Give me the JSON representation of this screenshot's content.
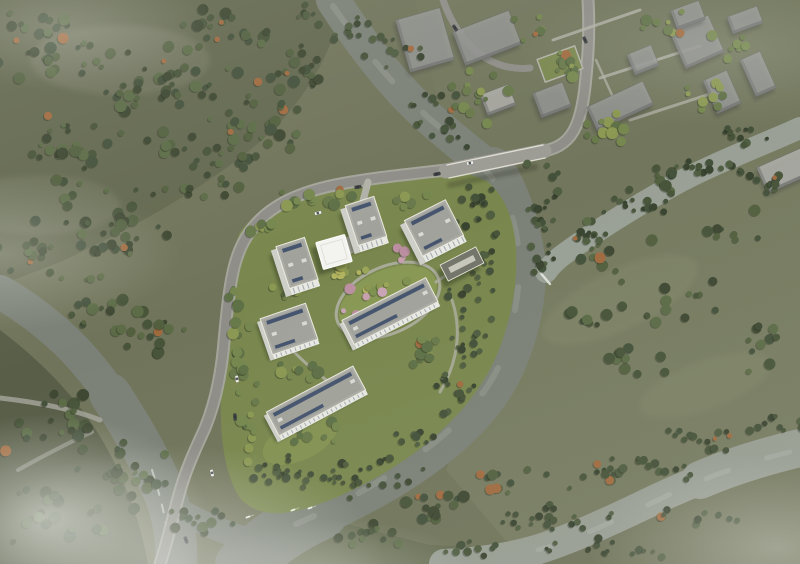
{
  "meta": {
    "title": "Aerial masterplan rendering of riverside residential development",
    "media_type": "architectural-visualization",
    "view": "bird's-eye aerial",
    "atmosphere": "overcast daylight with low mist in corners",
    "visible_text": "none"
  },
  "colors": {
    "base": "#70745a",
    "woodland": "#63684f",
    "woodland_dark": "#585e48",
    "woodland_haze": "#8a8c78",
    "field": "#767b60",
    "field_light": "#858a6c",
    "wedge": "#656c51",
    "context_ground": "#71765c",
    "river": "#7b8177",
    "river_light": "#979d92",
    "channel": "#99a095",
    "water_streak": "rgba(255,255,255,0.12)",
    "whitewater": "#e9ece5",
    "road": "#8e8d87",
    "road_edge": "#a7a69e",
    "path": "#b2b1a7",
    "bridge": "#9c9b94",
    "bridge_shadow": "rgba(40,44,38,0.30)",
    "lawn": "#79874e",
    "lawn_bright": "#8a9a55",
    "roof": "#abaca5",
    "roof_inner": "#9fa099",
    "roof_edge": "#eceade",
    "facade": "#e9e9e4",
    "facade_shade": "#cfcfca",
    "window": "#9aa4ab",
    "solar": "#40506b",
    "rooftop_unit": "#d9d9d4",
    "building_shadow": "rgba(38,42,32,0.42)",
    "canopy": "#f3f3ef",
    "amenity_roof": "#73756b",
    "skylight": "#c7c8bb",
    "context_fill": "rgba(151,152,150,0.82)",
    "context_light": "rgba(176,176,172,0.85)",
    "context_side": "rgba(113,114,112,0.80)",
    "context_shadow": "rgba(45,48,42,0.30)",
    "car_white": "#ecedea",
    "car_dark": "#3f4044",
    "car_glass": "rgba(40,45,50,0.8)",
    "boat": "#eef0ea",
    "tree": {
      "d": [
        "#3d4731",
        "#475439",
        "#52603f",
        "#43513b",
        "#5b6b46"
      ],
      "l": [
        "#68794a",
        "#75874e",
        "#8a9852",
        "#5e7046"
      ],
      "y": [
        "#9aa557",
        "#b1b35f",
        "#7f9150",
        "#8a9852"
      ],
      "p": [
        "#c79fae",
        "#bb8fa0",
        "#c9a3b4"
      ],
      "r": [
        "#394430",
        "#44513a",
        "#4f5d40",
        "#475439"
      ],
      "accent": "#a06a3f",
      "shadow": "rgba(28,33,23,0.32)"
    }
  },
  "site": {
    "name": "riverside-residential-complex",
    "buildings": [
      {
        "id": "tower-a",
        "label": "residential tower north",
        "type": "tower",
        "x": 366,
        "y": 221,
        "w": 30,
        "h": 42,
        "rot": -18
      },
      {
        "id": "tower-b",
        "label": "residential tower northeast",
        "type": "tower",
        "x": 434,
        "y": 228,
        "w": 46,
        "h": 40,
        "rot": -27
      },
      {
        "id": "tower-c",
        "label": "residential tower west",
        "type": "tower",
        "x": 297,
        "y": 263,
        "w": 30,
        "h": 44,
        "rot": -18
      },
      {
        "id": "entry-canopy",
        "label": "white entrance canopy pavilion",
        "type": "canopy",
        "x": 334,
        "y": 252,
        "w": 30,
        "h": 28,
        "rot": -16
      },
      {
        "id": "clubhouse",
        "label": "low amenity building with skylight",
        "type": "amenity",
        "x": 462,
        "y": 264,
        "w": 40,
        "h": 18,
        "rot": -27
      },
      {
        "id": "slab-a",
        "label": "central residential slab",
        "type": "slab",
        "x": 390,
        "y": 311,
        "w": 94,
        "h": 27,
        "rot": -27
      },
      {
        "id": "slab-b",
        "label": "west residential slab",
        "type": "slab",
        "x": 289,
        "y": 329,
        "w": 48,
        "h": 38,
        "rot": -19
      },
      {
        "id": "slab-c",
        "label": "south residential slab",
        "type": "slab",
        "x": 316,
        "y": 401,
        "w": 98,
        "h": 27,
        "rot": -28
      }
    ]
  },
  "context": {
    "label": "surrounding development massing (translucent grey blocks)",
    "blocks": [
      {
        "x": 425,
        "y": 40,
        "w": 46,
        "h": 54,
        "rot": -16,
        "light": false
      },
      {
        "x": 487,
        "y": 38,
        "w": 60,
        "h": 36,
        "rot": -21,
        "light": false
      },
      {
        "x": 498,
        "y": 100,
        "w": 30,
        "h": 22,
        "rot": -21,
        "light": true
      },
      {
        "x": 552,
        "y": 100,
        "w": 32,
        "h": 26,
        "rot": -21,
        "light": false
      },
      {
        "x": 620,
        "y": 106,
        "w": 62,
        "h": 26,
        "rot": -25,
        "light": false
      },
      {
        "x": 643,
        "y": 60,
        "w": 26,
        "h": 22,
        "rot": -22,
        "light": false
      },
      {
        "x": 697,
        "y": 42,
        "w": 42,
        "h": 40,
        "rot": -24,
        "light": false
      },
      {
        "x": 722,
        "y": 92,
        "w": 26,
        "h": 36,
        "rot": -24,
        "light": false
      },
      {
        "x": 758,
        "y": 74,
        "w": 22,
        "h": 40,
        "rot": -24,
        "light": false
      },
      {
        "x": 688,
        "y": 15,
        "w": 30,
        "h": 20,
        "rot": -20,
        "light": false
      },
      {
        "x": 745,
        "y": 20,
        "w": 32,
        "h": 18,
        "rot": -20,
        "light": false
      },
      {
        "x": 786,
        "y": 170,
        "w": 52,
        "h": 28,
        "rot": -24,
        "light": true
      }
    ]
  },
  "vegetation": {
    "zones": [
      {
        "x": 55,
        "y": 45,
        "rx": 75,
        "ry": 38,
        "n": 34,
        "p": "d"
      },
      {
        "x": 165,
        "y": 85,
        "rx": 85,
        "ry": 45,
        "n": 40,
        "p": "d"
      },
      {
        "x": 70,
        "y": 150,
        "rx": 70,
        "ry": 42,
        "n": 30,
        "p": "d"
      },
      {
        "x": 195,
        "y": 165,
        "rx": 75,
        "ry": 40,
        "n": 32,
        "p": "d"
      },
      {
        "x": 115,
        "y": 225,
        "rx": 85,
        "ry": 38,
        "n": 34,
        "p": "d"
      },
      {
        "x": 262,
        "y": 115,
        "rx": 55,
        "ry": 55,
        "n": 30,
        "p": "d"
      },
      {
        "x": 235,
        "y": 30,
        "rx": 55,
        "ry": 28,
        "n": 20,
        "p": "d"
      },
      {
        "x": 305,
        "y": 75,
        "rx": 38,
        "ry": 36,
        "n": 18,
        "p": "d"
      },
      {
        "x": 25,
        "y": 255,
        "rx": 40,
        "ry": 22,
        "n": 12,
        "p": "d"
      },
      {
        "x": 100,
        "y": 300,
        "rx": 50,
        "ry": 28,
        "n": 16,
        "p": "d"
      },
      {
        "x": 152,
        "y": 332,
        "rx": 55,
        "ry": 30,
        "n": 18,
        "p": "d"
      },
      {
        "x": 58,
        "y": 418,
        "rx": 55,
        "ry": 35,
        "n": 20,
        "p": "d"
      },
      {
        "x": 128,
        "y": 478,
        "rx": 65,
        "ry": 40,
        "n": 24,
        "p": "d"
      },
      {
        "x": 58,
        "y": 515,
        "rx": 70,
        "ry": 35,
        "n": 22,
        "p": "d"
      },
      {
        "x": 200,
        "y": 520,
        "rx": 40,
        "ry": 24,
        "n": 12,
        "p": "d"
      },
      {
        "x": 350,
        "y": 200,
        "rx": 95,
        "ry": 12,
        "n": 18,
        "p": "l"
      },
      {
        "x": 262,
        "y": 228,
        "rx": 24,
        "ry": 14,
        "n": 8,
        "p": "l"
      },
      {
        "x": 240,
        "y": 330,
        "rx": 13,
        "ry": 65,
        "n": 18,
        "p": "l"
      },
      {
        "x": 252,
        "y": 425,
        "rx": 15,
        "ry": 48,
        "n": 13,
        "p": "l"
      },
      {
        "x": 388,
        "y": 55,
        "rx": 40,
        "ry": 28,
        "n": 12,
        "p": "r"
      },
      {
        "x": 432,
        "y": 105,
        "rx": 26,
        "ry": 26,
        "n": 10,
        "p": "r"
      },
      {
        "x": 545,
        "y": 205,
        "rx": 20,
        "ry": 55,
        "n": 20,
        "p": "r"
      },
      {
        "x": 540,
        "y": 258,
        "rx": 16,
        "ry": 22,
        "n": 8,
        "p": "r"
      },
      {
        "x": 352,
        "y": 28,
        "rx": 30,
        "ry": 22,
        "n": 9,
        "p": "r"
      },
      {
        "x": 312,
        "y": 12,
        "rx": 24,
        "ry": 14,
        "n": 6,
        "p": "r"
      },
      {
        "x": 478,
        "y": 205,
        "rx": 26,
        "ry": 30,
        "n": 14,
        "p": "r"
      },
      {
        "x": 486,
        "y": 262,
        "rx": 20,
        "ry": 40,
        "n": 16,
        "p": "r"
      },
      {
        "x": 472,
        "y": 330,
        "rx": 22,
        "ry": 40,
        "n": 16,
        "p": "r"
      },
      {
        "x": 448,
        "y": 395,
        "rx": 30,
        "ry": 28,
        "n": 14,
        "p": "r"
      },
      {
        "x": 455,
        "y": 290,
        "rx": 16,
        "ry": 12,
        "n": 6,
        "p": "r"
      },
      {
        "x": 390,
        "y": 296,
        "rx": 46,
        "ry": 20,
        "n": 13,
        "p": "y"
      },
      {
        "x": 348,
        "y": 272,
        "rx": 24,
        "ry": 16,
        "n": 8,
        "p": "y"
      },
      {
        "x": 360,
        "y": 305,
        "rx": 35,
        "ry": 18,
        "n": 6,
        "p": "p"
      },
      {
        "x": 415,
        "y": 250,
        "rx": 28,
        "ry": 12,
        "n": 7,
        "p": "p"
      },
      {
        "x": 428,
        "y": 352,
        "rx": 32,
        "ry": 16,
        "n": 9,
        "p": "l"
      },
      {
        "x": 300,
        "y": 372,
        "rx": 28,
        "ry": 14,
        "n": 8,
        "p": "l"
      },
      {
        "x": 318,
        "y": 432,
        "rx": 30,
        "ry": 14,
        "n": 8,
        "p": "l"
      },
      {
        "x": 282,
        "y": 290,
        "rx": 20,
        "ry": 12,
        "n": 6,
        "p": "l"
      },
      {
        "x": 352,
        "y": 478,
        "rx": 85,
        "ry": 25,
        "n": 28,
        "p": "r"
      },
      {
        "x": 270,
        "y": 468,
        "rx": 40,
        "ry": 22,
        "n": 13,
        "p": "r"
      },
      {
        "x": 418,
        "y": 440,
        "rx": 35,
        "ry": 20,
        "n": 11,
        "p": "r"
      },
      {
        "x": 598,
        "y": 245,
        "rx": 55,
        "ry": 30,
        "n": 12,
        "p": "d"
      },
      {
        "x": 678,
        "y": 300,
        "rx": 65,
        "ry": 35,
        "n": 14,
        "p": "d"
      },
      {
        "x": 622,
        "y": 362,
        "rx": 50,
        "ry": 28,
        "n": 11,
        "p": "d"
      },
      {
        "x": 728,
        "y": 225,
        "rx": 38,
        "ry": 22,
        "n": 8,
        "p": "d"
      },
      {
        "x": 755,
        "y": 350,
        "rx": 40,
        "ry": 28,
        "n": 10,
        "p": "d"
      },
      {
        "x": 665,
        "y": 182,
        "rx": 45,
        "ry": 18,
        "n": 9,
        "p": "d"
      },
      {
        "x": 580,
        "y": 320,
        "rx": 30,
        "ry": 20,
        "n": 7,
        "p": "d"
      },
      {
        "x": 700,
        "y": 170,
        "rx": 55,
        "ry": 15,
        "n": 18,
        "p": "r"
      },
      {
        "x": 640,
        "y": 205,
        "rx": 45,
        "ry": 13,
        "n": 14,
        "p": "r"
      },
      {
        "x": 588,
        "y": 238,
        "rx": 40,
        "ry": 12,
        "n": 12,
        "p": "r"
      },
      {
        "x": 745,
        "y": 135,
        "rx": 35,
        "ry": 12,
        "n": 11,
        "p": "r"
      },
      {
        "x": 772,
        "y": 185,
        "rx": 28,
        "ry": 15,
        "n": 10,
        "p": "r"
      },
      {
        "x": 628,
        "y": 472,
        "rx": 85,
        "ry": 18,
        "n": 26,
        "p": "r"
      },
      {
        "x": 548,
        "y": 520,
        "rx": 70,
        "ry": 16,
        "n": 21,
        "p": "r"
      },
      {
        "x": 712,
        "y": 438,
        "rx": 55,
        "ry": 15,
        "n": 16,
        "p": "r"
      },
      {
        "x": 775,
        "y": 425,
        "rx": 30,
        "ry": 12,
        "n": 8,
        "p": "r"
      },
      {
        "x": 600,
        "y": 548,
        "rx": 80,
        "ry": 12,
        "n": 16,
        "p": "r"
      },
      {
        "x": 700,
        "y": 515,
        "rx": 60,
        "ry": 13,
        "n": 12,
        "p": "r"
      },
      {
        "x": 470,
        "y": 548,
        "rx": 40,
        "ry": 11,
        "n": 9,
        "p": "r"
      },
      {
        "x": 432,
        "y": 502,
        "rx": 55,
        "ry": 24,
        "n": 18,
        "p": "d"
      },
      {
        "x": 368,
        "y": 535,
        "rx": 45,
        "ry": 16,
        "n": 12,
        "p": "d"
      },
      {
        "x": 500,
        "y": 482,
        "rx": 35,
        "ry": 18,
        "n": 10,
        "p": "d"
      },
      {
        "x": 478,
        "y": 92,
        "rx": 35,
        "ry": 35,
        "n": 14,
        "p": "l"
      },
      {
        "x": 558,
        "y": 62,
        "rx": 30,
        "ry": 24,
        "n": 11,
        "p": "l"
      },
      {
        "x": 608,
        "y": 130,
        "rx": 35,
        "ry": 20,
        "n": 11,
        "p": "l"
      },
      {
        "x": 700,
        "y": 92,
        "rx": 32,
        "ry": 22,
        "n": 9,
        "p": "l"
      },
      {
        "x": 662,
        "y": 22,
        "rx": 35,
        "ry": 16,
        "n": 9,
        "p": "l"
      },
      {
        "x": 732,
        "y": 48,
        "rx": 24,
        "ry": 16,
        "n": 7,
        "p": "l"
      },
      {
        "x": 452,
        "y": 132,
        "rx": 26,
        "ry": 20,
        "n": 9,
        "p": "r"
      },
      {
        "x": 530,
        "y": 28,
        "rx": 24,
        "ry": 16,
        "n": 7,
        "p": "l"
      }
    ]
  },
  "vehicles": {
    "cars": [
      {
        "x": 318,
        "y": 213,
        "rot": -14,
        "c": "white"
      },
      {
        "x": 358,
        "y": 187,
        "rot": -10,
        "c": "dark"
      },
      {
        "x": 470,
        "y": 163,
        "rot": -11,
        "c": "white"
      },
      {
        "x": 437,
        "y": 174,
        "rot": -11,
        "c": "dark"
      },
      {
        "x": 237,
        "y": 379,
        "rot": 83,
        "c": "white"
      },
      {
        "x": 235,
        "y": 417,
        "rot": 86,
        "c": "dark"
      },
      {
        "x": 585,
        "y": 40,
        "rot": 65,
        "c": "dark"
      },
      {
        "x": 212,
        "y": 473,
        "rot": 78,
        "c": "white"
      },
      {
        "x": 186,
        "y": 540,
        "rot": 70,
        "c": "dark"
      },
      {
        "x": 455,
        "y": 28,
        "rot": 55,
        "c": "dark"
      }
    ],
    "boats": [
      {
        "x": 248,
        "y": 517
      },
      {
        "x": 293,
        "y": 510
      },
      {
        "x": 310,
        "y": 508
      }
    ]
  }
}
